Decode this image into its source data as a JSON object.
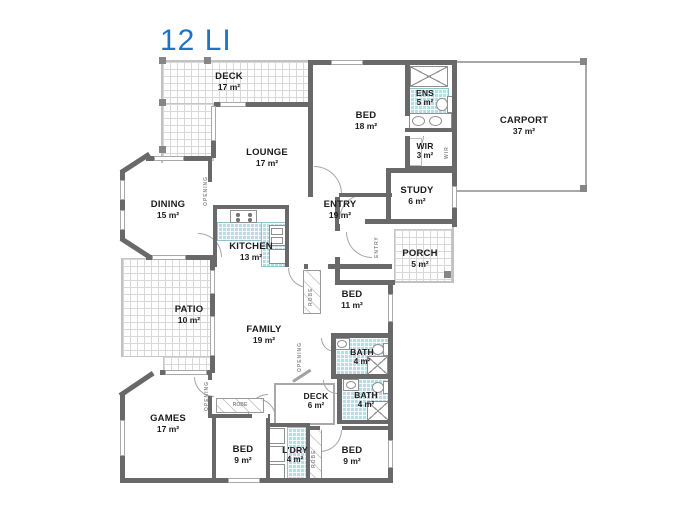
{
  "title": {
    "text": "12 LI"
  },
  "colors": {
    "title_blue": "#1e73c6",
    "wall_gray": "#696969",
    "wet_tile_teal": "#b9dde2",
    "outdoor_tile_line": "#d8d8d8"
  },
  "rooms": [
    {
      "name": "DECK",
      "area": "17 m²"
    },
    {
      "name": "BED",
      "area": "18 m²"
    },
    {
      "name": "ENS",
      "area": "5 m²"
    },
    {
      "name": "CARPORT",
      "area": "37 m²"
    },
    {
      "name": "LOUNGE",
      "area": "17 m²"
    },
    {
      "name": "WIR",
      "area": "3 m²"
    },
    {
      "name": "STUDY",
      "area": "6 m²"
    },
    {
      "name": "DINING",
      "area": "15 m²"
    },
    {
      "name": "ENTRY",
      "area": "19 m²"
    },
    {
      "name": "KITCHEN",
      "area": "13 m²"
    },
    {
      "name": "PORCH",
      "area": "5 m²"
    },
    {
      "name": "PATIO",
      "area": "10 m²"
    },
    {
      "name": "FAMILY",
      "area": "19 m²"
    },
    {
      "name": "BED",
      "area": "11 m²"
    },
    {
      "name": "BATH",
      "area": "4 m²"
    },
    {
      "name": "BATH",
      "area": "4 m²"
    },
    {
      "name": "GAMES",
      "area": "17 m²"
    },
    {
      "name": "DECK",
      "area": "6 m²"
    },
    {
      "name": "BED",
      "area": "9 m²"
    },
    {
      "name": "L'DRY",
      "area": "4 m²"
    },
    {
      "name": "BED",
      "area": "9 m²"
    }
  ],
  "annotations": {
    "opening": "OPENING",
    "entry_hall": "ENTRY",
    "robe": "ROBE",
    "wir": "WIR"
  }
}
